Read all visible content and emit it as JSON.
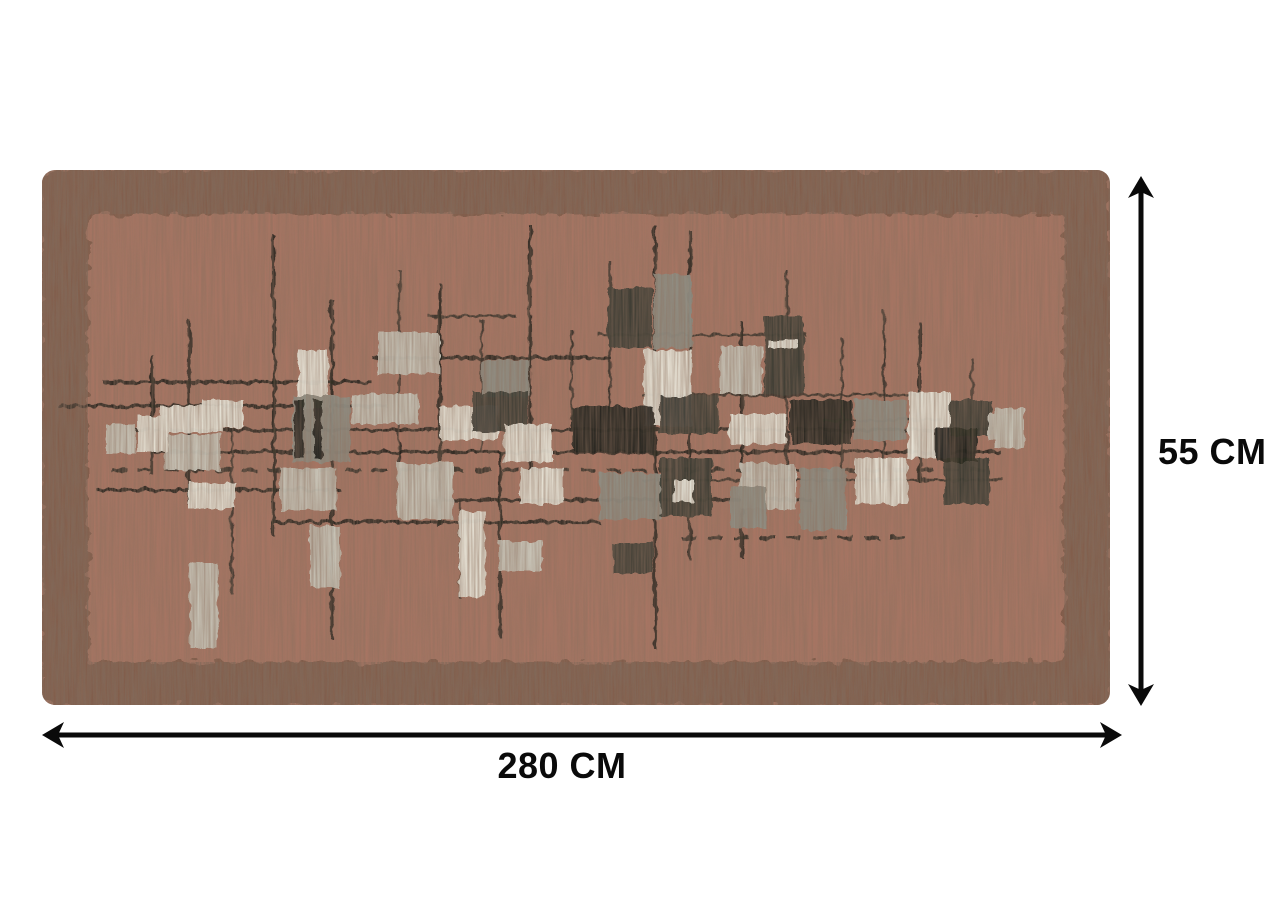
{
  "page": {
    "background_color": "#ffffff",
    "content": "product-dimension-diagram"
  },
  "product_diagram": {
    "item": "patterned-area-rug",
    "dimensions": {
      "width": {
        "value": 280,
        "unit": "CM",
        "label": "280 CM"
      },
      "height": {
        "value": 55,
        "unit": "CM",
        "label": "55 CM"
      }
    }
  },
  "colors": {
    "page_bg": "#ffffff",
    "rug_field": "#a77563",
    "rug_border": "#7f5b49",
    "motif_cream": "#e9e6da",
    "motif_light": "#c8c5b8",
    "motif_mid": "#8f8e83",
    "motif_dark": "#3b3c34",
    "motif_black": "#23241e",
    "motif_line": "#26251f",
    "dimension": "#0a0a0a"
  }
}
